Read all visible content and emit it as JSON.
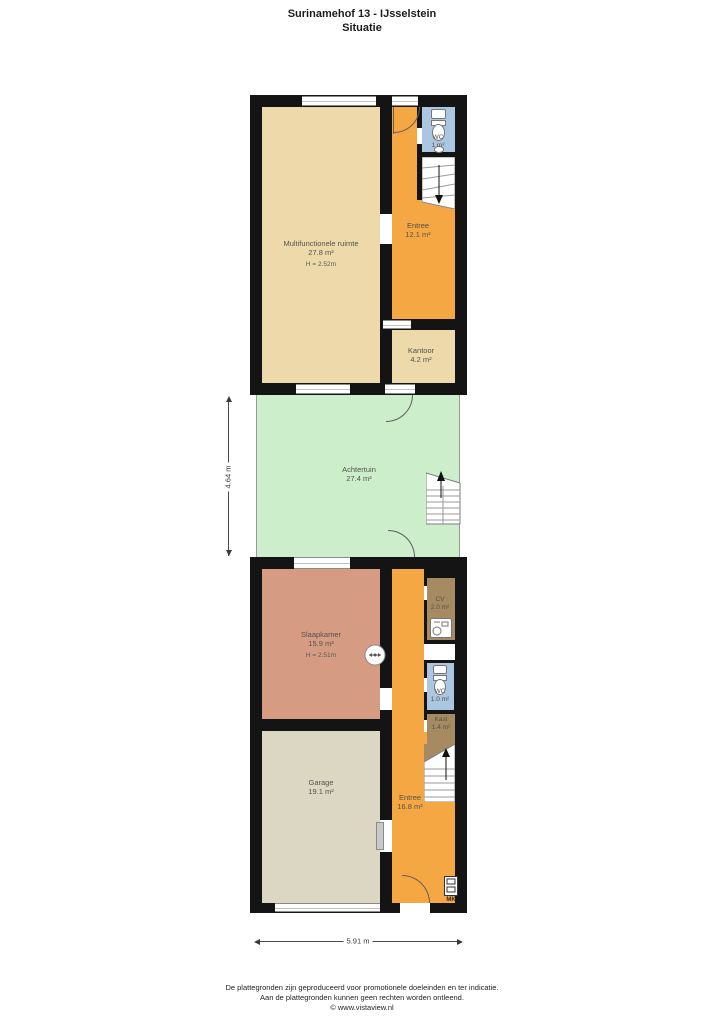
{
  "title": {
    "address": "Surinamehof 13 - IJsselstein",
    "subtitle": "Situatie"
  },
  "rooms": {
    "multifunctionele_ruimte": {
      "name": "Multifunctionele ruimte",
      "area": "27.8 m²",
      "height": "H = 2.52m"
    },
    "entree_boven": {
      "name": "Entree",
      "area": "12.1 m²"
    },
    "wc_boven": {
      "name": "WC",
      "area": "1 m²"
    },
    "kantoor": {
      "name": "Kantoor",
      "area": "4.2 m²"
    },
    "achtertuin": {
      "name": "Achtertuin",
      "area": "27.4 m²"
    },
    "slaapkamer": {
      "name": "Slaapkamer",
      "area": "15.9 m²",
      "height": "H = 2.51m"
    },
    "cv": {
      "name": "CV",
      "area": "2.0 m²"
    },
    "wc_beneden": {
      "name": "WC",
      "area": "1.0 m²"
    },
    "kast": {
      "name": "Kast",
      "area": "1.4 m²"
    },
    "entree_beneden": {
      "name": "Entree",
      "area": "16.8 m²"
    },
    "garage": {
      "name": "Garage",
      "area": "19.1 m²"
    }
  },
  "fixtures": {
    "meterkast_label": "MK"
  },
  "dimensions": {
    "garden_height": "4.64 m",
    "building_width": "5.91 m"
  },
  "footer": {
    "line1": "De plattegronden zijn geproduceerd voor promotionele doeleinden en ter indicatie.",
    "line2": "Aan de plattegronden kunnen geen rechten worden ontleend.",
    "line3": "© www.vistaview.nl"
  },
  "colors": {
    "wall": "#141414",
    "room_beige": "#eed9aa",
    "room_orange": "#f4a742",
    "room_blue": "#abc6e0",
    "room_brown": "#a68a62",
    "room_salmon": "#d69b83",
    "room_garage": "#dcd7c3",
    "garden_green": "#cceecb"
  }
}
